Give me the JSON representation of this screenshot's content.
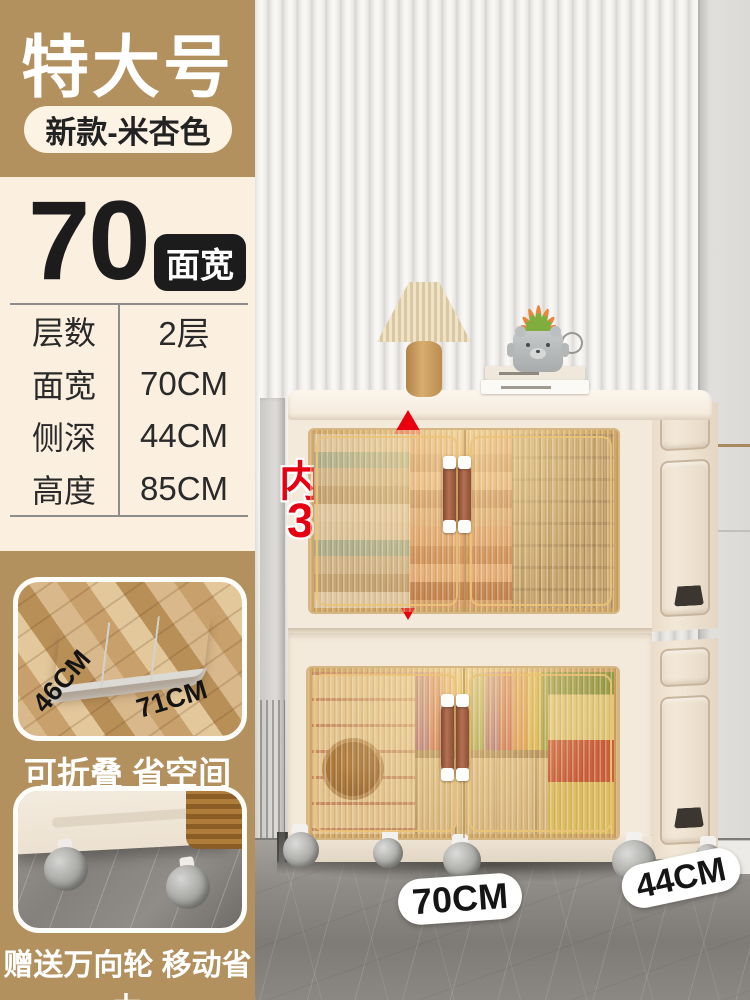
{
  "banner": {
    "title": "特大号",
    "variant": "新款-米杏色"
  },
  "highlight": {
    "number": "70",
    "unit_label": "面宽"
  },
  "spec_table": {
    "rows": [
      {
        "label": "层数",
        "value": "2层"
      },
      {
        "label": "面宽",
        "value": "70CM"
      },
      {
        "label": "侧深",
        "value": "44CM"
      },
      {
        "label": "高度",
        "value": "85CM"
      }
    ]
  },
  "photo_annotations": {
    "inner_height_label": "内部高",
    "inner_height_value": "38CM",
    "width_tag": "70CM",
    "depth_tag": "44CM"
  },
  "features": {
    "fold": {
      "caption": "可折叠 省空间",
      "depth_label": "46CM",
      "width_label": "71CM"
    },
    "wheels": {
      "caption": "赠送万向轮 移动省力"
    }
  },
  "colors": {
    "banner_tan": "#b3915f",
    "panel_cream": "#fbf0e0",
    "accent_red": "#e60012",
    "cabinet_cream": "#f3e9db",
    "handle_brown": "#9a5f42",
    "spec_pill_black": "#1c1c1c"
  }
}
